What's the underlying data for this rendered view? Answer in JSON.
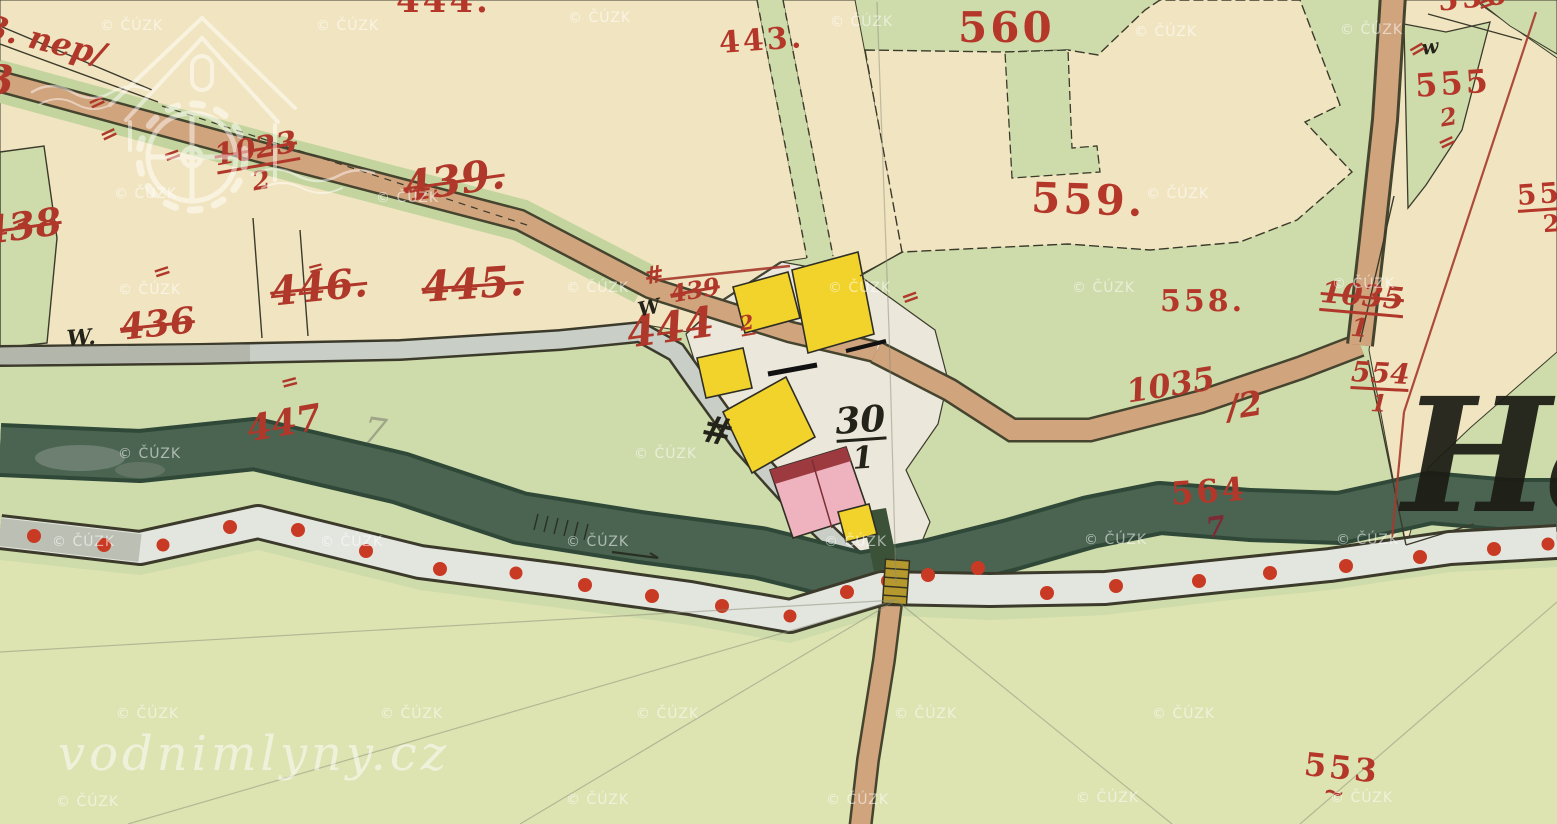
{
  "map": {
    "source_watermark": "© ČÚZK",
    "logo": {
      "site": "vodnimlyny.cz",
      "icon": "watermill-house-icon"
    },
    "place_name_fragment": "Ha",
    "colors": {
      "paper_cream": "#f1e5c1",
      "meadow_green": "#cedbaa",
      "bottom_green": "#dde4b1",
      "river_green": "#4a6451",
      "path_grey": "#c9cfc6",
      "road_tan": "#d0a47d",
      "building_yellow": "#f2d32b",
      "building_pink": "#efb3c0",
      "roof_dark_red": "#9c3a40",
      "label_red": "#b5372a",
      "dot_red": "#c93a24",
      "ink": "#3b3a2b"
    },
    "labels": [
      {
        "name": "parcel-444-top",
        "text": "444.",
        "x": 396,
        "y": -16,
        "size": 34,
        "rot": 0,
        "style": "print"
      },
      {
        "name": "parcel-443",
        "text": "443.",
        "x": 718,
        "y": 28,
        "size": 30,
        "rot": -4,
        "style": "print"
      },
      {
        "name": "parcel-560",
        "text": "560",
        "x": 958,
        "y": 6,
        "size": 42,
        "rot": 0,
        "style": "print"
      },
      {
        "name": "parcel-559",
        "text": "559.",
        "x": 1032,
        "y": 176,
        "size": 42,
        "rot": 2,
        "style": "print"
      },
      {
        "name": "parcel-558",
        "text": "558.",
        "x": 1160,
        "y": 286,
        "size": 30,
        "rot": 0,
        "style": "print"
      },
      {
        "name": "parcel-564",
        "text": "564",
        "x": 1170,
        "y": 478,
        "size": 32,
        "rot": -4,
        "style": "print"
      },
      {
        "name": "parcel-564-sub",
        "text": "7",
        "x": 1204,
        "y": 514,
        "size": 28,
        "rot": -8,
        "style": "dark-hand"
      },
      {
        "name": "parcel-553",
        "text": "553",
        "x": 1306,
        "y": 748,
        "size": 32,
        "rot": 6,
        "style": "print"
      },
      {
        "name": "parcel-553-mark",
        "text": "~",
        "x": 1326,
        "y": 778,
        "size": 26,
        "rot": 12,
        "style": "hand"
      },
      {
        "name": "parcel-556",
        "text": "556",
        "x": 1436,
        "y": -14,
        "size": 30,
        "rot": -6,
        "style": "print"
      },
      {
        "name": "parcel-555",
        "text": "555",
        "x": 1414,
        "y": 70,
        "size": 32,
        "rot": -4,
        "style": "print"
      },
      {
        "name": "parcel-555-sub",
        "text": "2",
        "x": 1438,
        "y": 106,
        "size": 24,
        "rot": -10,
        "style": "hand"
      },
      {
        "name": "parcel-555-2-edge",
        "frac": {
          "num": "555",
          "den": "2"
        },
        "x": 1516,
        "y": 182,
        "size": 28,
        "rot": -4,
        "style": "print"
      },
      {
        "name": "note-nep",
        "text": "3. nep/",
        "x": -10,
        "y": 10,
        "size": 32,
        "rot": 14,
        "style": "hand"
      },
      {
        "name": "parcel-edge-cut",
        "text": "3",
        "x": -14,
        "y": 60,
        "size": 40,
        "rot": 0,
        "style": "hand"
      },
      {
        "name": "parcel-1023-2",
        "frac": {
          "num": "1023",
          "den": "2",
          "struck": true
        },
        "x": 212,
        "y": 142,
        "size": 30,
        "rot": -10,
        "style": "hand"
      },
      {
        "name": "parcel-439-old",
        "text": "439.",
        "x": 400,
        "y": 166,
        "size": 42,
        "rot": -8,
        "style": "hand-struck"
      },
      {
        "name": "parcel-445",
        "text": "445.",
        "x": 420,
        "y": 266,
        "size": 42,
        "rot": -4,
        "style": "hand-struck"
      },
      {
        "name": "parcel-446",
        "text": "446.",
        "x": 268,
        "y": 272,
        "size": 40,
        "rot": -6,
        "style": "hand-struck"
      },
      {
        "name": "parcel-436",
        "text": "436",
        "x": 118,
        "y": 310,
        "size": 36,
        "rot": -6,
        "style": "hand-struck"
      },
      {
        "name": "parcel-438",
        "text": "438",
        "x": -20,
        "y": 212,
        "size": 38,
        "rot": -8,
        "style": "hand-struck"
      },
      {
        "name": "parcel-444-hand",
        "text": "444",
        "x": 624,
        "y": 312,
        "size": 42,
        "rot": -8,
        "style": "hand"
      },
      {
        "name": "parcel-439-2-num",
        "text": "439",
        "x": 668,
        "y": 282,
        "size": 24,
        "rot": -10,
        "style": "hand-struck"
      },
      {
        "name": "parcel-439-2-den",
        "text": "2",
        "x": 738,
        "y": 314,
        "size": 20,
        "rot": -10,
        "style": "hand",
        "underline": true
      },
      {
        "name": "mark-hash-red",
        "text": "#",
        "x": 642,
        "y": 264,
        "size": 24,
        "rot": -10,
        "style": "hand"
      },
      {
        "name": "parcel-447",
        "text": "447",
        "x": 244,
        "y": 412,
        "size": 36,
        "rot": -10,
        "style": "hand"
      },
      {
        "name": "pencil-7",
        "text": "7",
        "x": 366,
        "y": 412,
        "size": 36,
        "rot": 8,
        "style": "pencil"
      },
      {
        "name": "parcel-1035-2",
        "text": "1035",
        "x": 1124,
        "y": 376,
        "size": 32,
        "rot": -9,
        "style": "hand"
      },
      {
        "name": "parcel-1035-2-den",
        "text": "/2",
        "x": 1224,
        "y": 392,
        "size": 34,
        "rot": -9,
        "style": "hand"
      },
      {
        "name": "parcel-1035-1",
        "frac": {
          "num": "1035",
          "den": "1",
          "struck": true
        },
        "x": 1322,
        "y": 278,
        "size": 30,
        "rot": 5,
        "style": "hand"
      },
      {
        "name": "parcel-554-1",
        "frac": {
          "num": "554",
          "den": "1"
        },
        "x": 1352,
        "y": 358,
        "size": 28,
        "rot": 3,
        "style": "hand"
      },
      {
        "name": "house-30-1",
        "frac": {
          "num": "30",
          "den": "1"
        },
        "x": 834,
        "y": 404,
        "size": 36,
        "rot": -4,
        "style": "black-hand"
      },
      {
        "name": "mark-w-left",
        "text": "W.",
        "x": 66,
        "y": 328,
        "size": 22,
        "rot": -4,
        "style": "black-hand"
      },
      {
        "name": "mark-w-mid",
        "text": "W",
        "x": 636,
        "y": 300,
        "size": 20,
        "rot": -12,
        "style": "black-hand"
      },
      {
        "name": "mark-w-right",
        "text": "w",
        "x": 1420,
        "y": 38,
        "size": 20,
        "rot": -8,
        "style": "black-hand"
      },
      {
        "name": "mark-hash",
        "text": "#",
        "x": 706,
        "y": 408,
        "size": 38,
        "rot": 12,
        "style": "black-hand"
      },
      {
        "name": "boundary-tick",
        "text": "=",
        "x": 84,
        "y": 96,
        "size": 22,
        "rot": -25,
        "style": "tick"
      },
      {
        "name": "boundary-tick",
        "text": "=",
        "x": 96,
        "y": 128,
        "size": 22,
        "rot": -25,
        "style": "tick"
      },
      {
        "name": "boundary-tick",
        "text": "=",
        "x": 8,
        "y": 216,
        "size": 22,
        "rot": -20,
        "style": "tick"
      },
      {
        "name": "boundary-tick",
        "text": "=",
        "x": 150,
        "y": 264,
        "size": 22,
        "rot": -18,
        "style": "tick"
      },
      {
        "name": "boundary-tick",
        "text": "=",
        "x": 160,
        "y": 148,
        "size": 22,
        "rot": -20,
        "style": "tick"
      },
      {
        "name": "boundary-tick",
        "text": "=",
        "x": 278,
        "y": 374,
        "size": 22,
        "rot": -15,
        "style": "tick"
      },
      {
        "name": "boundary-tick",
        "text": "=",
        "x": 305,
        "y": 260,
        "size": 20,
        "rot": -15,
        "style": "tick"
      },
      {
        "name": "boundary-tick",
        "text": "=",
        "x": 898,
        "y": 290,
        "size": 22,
        "rot": -20,
        "style": "tick"
      },
      {
        "name": "boundary-tick",
        "text": "=",
        "x": 1404,
        "y": 44,
        "size": 22,
        "rot": -30,
        "style": "tick"
      },
      {
        "name": "boundary-tick",
        "text": "=",
        "x": 1474,
        "y": -4,
        "size": 22,
        "rot": -20,
        "style": "tick"
      },
      {
        "name": "boundary-tick",
        "text": "=",
        "x": 1434,
        "y": 136,
        "size": 22,
        "rot": -25,
        "style": "tick"
      }
    ],
    "watermark_positions": [
      [
        100,
        18
      ],
      [
        316,
        18
      ],
      [
        568,
        10
      ],
      [
        830,
        14
      ],
      [
        1134,
        24
      ],
      [
        1340,
        22
      ],
      [
        114,
        186
      ],
      [
        376,
        190
      ],
      [
        1146,
        186
      ],
      [
        118,
        282
      ],
      [
        566,
        280
      ],
      [
        828,
        280
      ],
      [
        1072,
        280
      ],
      [
        1332,
        276
      ],
      [
        118,
        446
      ],
      [
        634,
        446
      ],
      [
        52,
        534
      ],
      [
        320,
        534
      ],
      [
        566,
        534
      ],
      [
        824,
        534
      ],
      [
        1084,
        532
      ],
      [
        1336,
        532
      ],
      [
        116,
        706
      ],
      [
        380,
        706
      ],
      [
        636,
        706
      ],
      [
        894,
        706
      ],
      [
        1152,
        706
      ],
      [
        56,
        794
      ],
      [
        566,
        792
      ],
      [
        826,
        792
      ],
      [
        1076,
        790
      ],
      [
        1330,
        790
      ]
    ]
  }
}
